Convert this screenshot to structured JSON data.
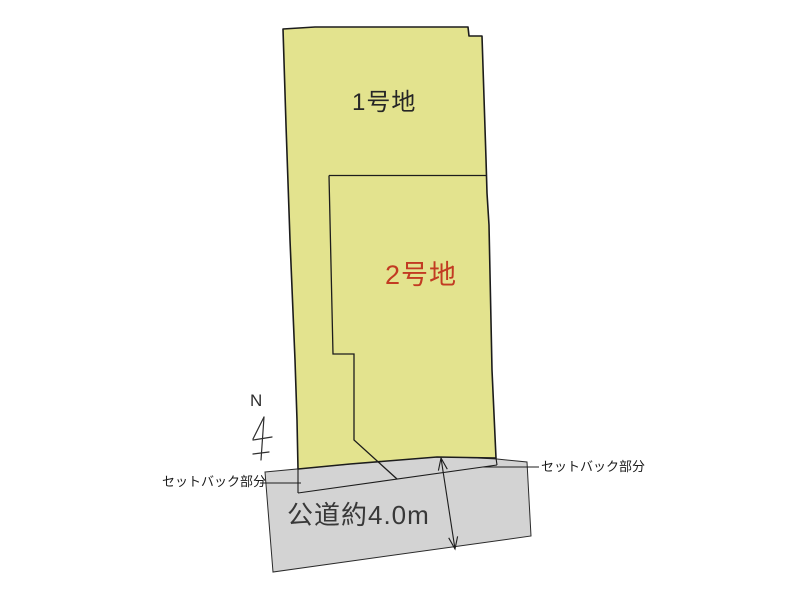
{
  "diagram_title": "land-plot-layout",
  "plots": [
    {
      "id": "plot-1",
      "label": "1号地",
      "label_color": "#262626"
    },
    {
      "id": "plot-2",
      "label": "2号地",
      "label_color": "#c23b22"
    }
  ],
  "road": {
    "label": "公道約4.0m",
    "width_note": "約4.0m"
  },
  "setback_left": {
    "label": "セットバック部分"
  },
  "setback_right": {
    "label": "セットバック部分"
  },
  "north": {
    "label": "N"
  },
  "colors": {
    "plot_fill": "#e3e38e",
    "road_fill": "#d3d3d3",
    "outline": "#1a1a1a",
    "plot2_label_color": "#c23b22",
    "background": "#ffffff"
  }
}
